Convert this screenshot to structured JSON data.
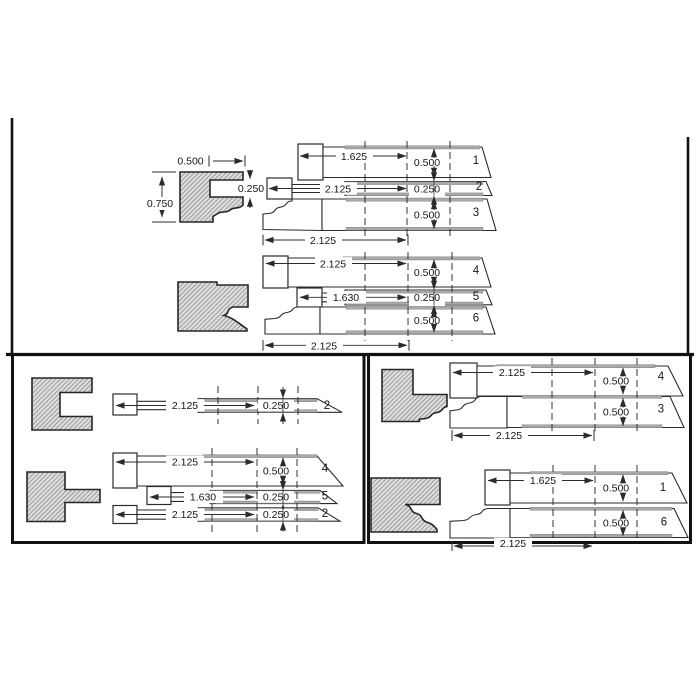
{
  "meta": {
    "type": "technical-line-drawing",
    "description": "Moulding knife profile set-up diagram with hatched profile blocks and numbered knife bars"
  },
  "colors": {
    "line": "#2b2b2b",
    "band_gray": "#a9a9a9",
    "hatch_line": "#6f6f6f",
    "hatch_bg": "#dcdcdc",
    "border": "#111111",
    "paper": "#ffffff"
  },
  "panels": {
    "top": {
      "profile": {
        "width": "0.500",
        "height": "0.750",
        "notch": "0.250"
      },
      "group1": {
        "bars": [
          {
            "no": "1",
            "len": "1.625",
            "h": "0.500"
          },
          {
            "no": "2",
            "len": "2.125",
            "h": "0.250"
          },
          {
            "no": "3",
            "h": "0.500"
          }
        ],
        "total": "2.125"
      },
      "group2": {
        "bars": [
          {
            "no": "4",
            "len": "2.125",
            "h": "0.500"
          },
          {
            "no": "5",
            "len": "1.630",
            "h": "0.250"
          },
          {
            "no": "6",
            "h": "0.500"
          }
        ],
        "total": "2.125"
      }
    },
    "bottom_left": {
      "group1": {
        "bars": [
          {
            "no": "2",
            "len": "2.125",
            "h": "0.250"
          }
        ]
      },
      "group2": {
        "bars": [
          {
            "no": "4",
            "len": "2.125",
            "h": "0.500"
          },
          {
            "no": "5",
            "len": "1.630",
            "h": "0.250"
          },
          {
            "no": "2",
            "len": "2.125",
            "h": "0.250"
          }
        ]
      }
    },
    "bottom_right": {
      "group1": {
        "bars": [
          {
            "no": "4",
            "len": "2.125",
            "h": "0.500"
          },
          {
            "no": "3",
            "h": "0.500"
          }
        ],
        "total": "2.125"
      },
      "group2": {
        "bars": [
          {
            "no": "1",
            "len": "1.625",
            "h": "0.500"
          },
          {
            "no": "6",
            "h": "0.500"
          }
        ],
        "total": "2.125"
      }
    }
  }
}
